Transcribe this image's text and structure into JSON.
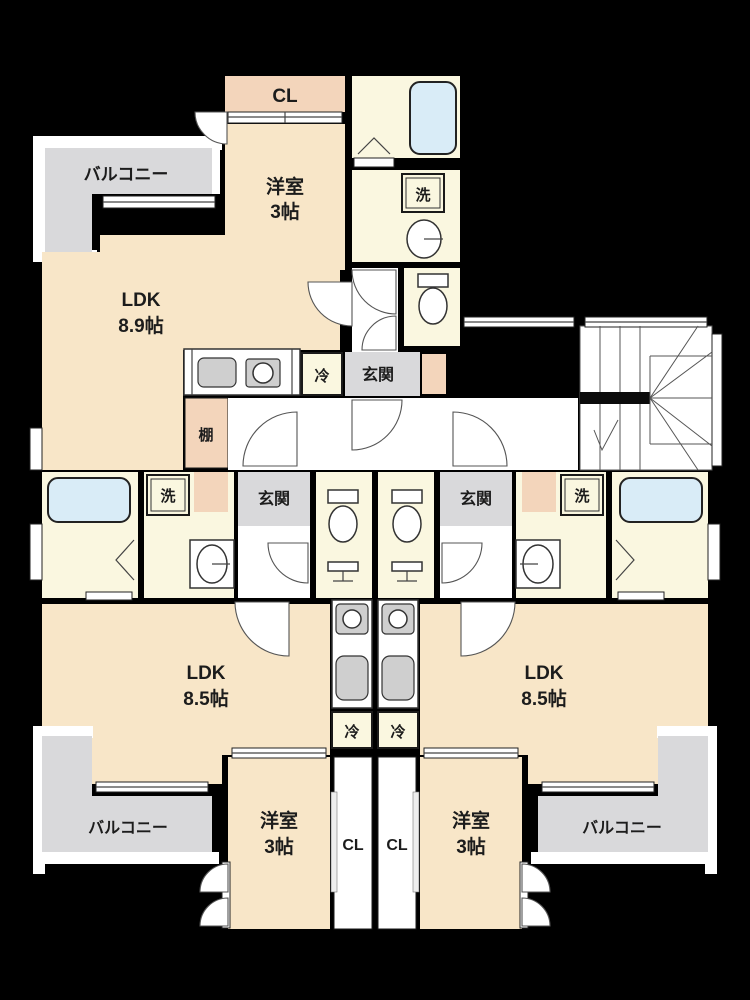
{
  "plan_type": "apartment-floor-plan",
  "labels": {
    "balcony": "バルコニー",
    "closet": "CL",
    "western_room": "洋室",
    "western_room_size": "3帖",
    "ldk": "LDK",
    "ldk_size_top": "8.9帖",
    "ldk_size_bottom": "8.5帖",
    "wash": "洗",
    "fridge": "冷",
    "entrance": "玄関",
    "shelf": "棚"
  },
  "units": [
    {
      "position": "top",
      "rooms": [
        "LDK 8.9帖",
        "洋室 3帖",
        "CL",
        "バルコニー",
        "玄関",
        "洗",
        "冷",
        "棚"
      ]
    },
    {
      "position": "bottom-left",
      "rooms": [
        "LDK 8.5帖",
        "洋室 3帖",
        "CL",
        "バルコニー",
        "玄関",
        "洗",
        "冷"
      ]
    },
    {
      "position": "bottom-right",
      "rooms": [
        "LDK 8.5帖",
        "洋室 3帖",
        "CL",
        "バルコニー",
        "玄関",
        "洗",
        "冷"
      ]
    }
  ],
  "colors": {
    "background": "#000000",
    "room_main": "#f8e6c8",
    "closet_band": "#f3d5bb",
    "wet_area": "#faf7e0",
    "balcony_gray": "#d9d9db",
    "bathtub_blue": "#d9ecf7",
    "line_white": "#ffffff"
  }
}
